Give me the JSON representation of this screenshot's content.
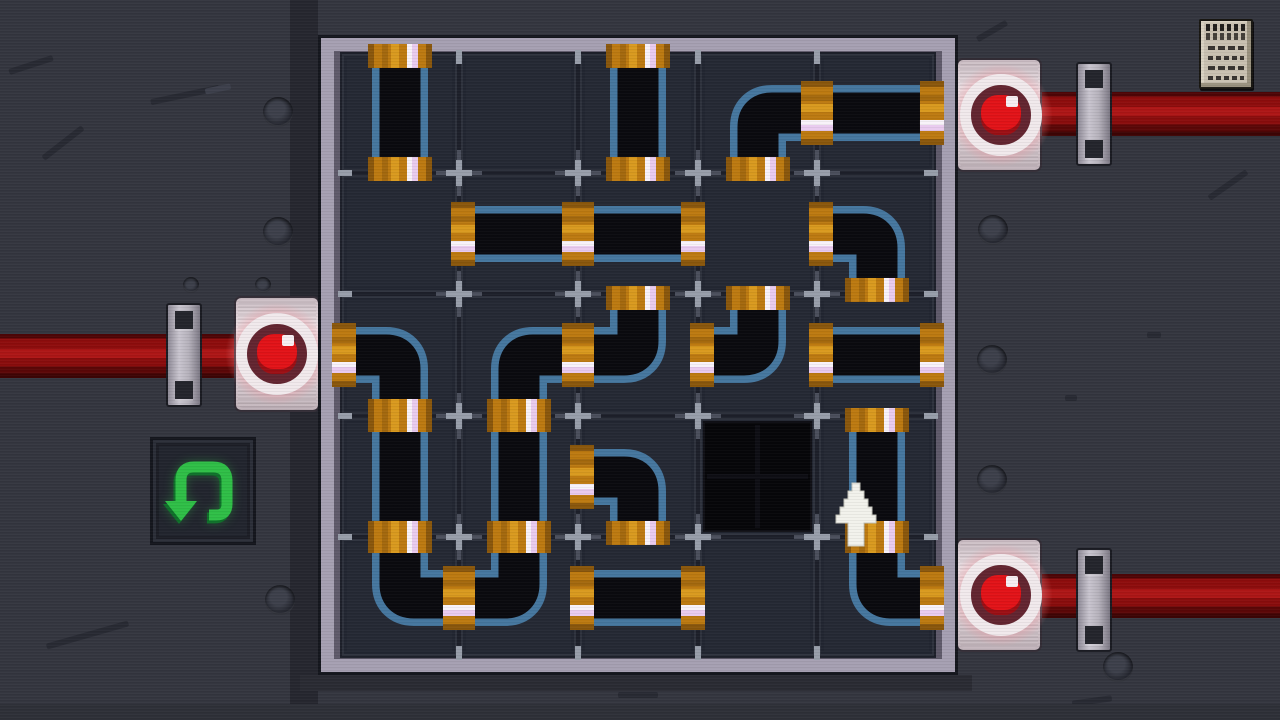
{
  "puzzle": {
    "rows": 5,
    "cols": 5,
    "cells": [
      [
        "v",
        "",
        "v",
        "SE",
        "h"
      ],
      [
        "",
        "h",
        "h",
        "",
        "SW"
      ],
      [
        "SW",
        "SE",
        "NW",
        "NW",
        "h"
      ],
      [
        "v",
        "v",
        "SW",
        "hole",
        "v"
      ],
      [
        "NE",
        "NW",
        "h",
        "",
        "NE"
      ]
    ],
    "legend": {
      "v": "vertical-pipe",
      "h": "horizontal-pipe",
      "SE": "elbow-bottom-right",
      "SW": "elbow-bottom-left",
      "NW": "elbow-top-left",
      "NE": "elbow-top-right",
      "hole": "empty-socket",
      "": "empty-cell"
    }
  },
  "valves": [
    {
      "name": "left-valve",
      "side": "left",
      "grid_row": 2,
      "light": "red"
    },
    {
      "name": "top-right-valve",
      "side": "right",
      "grid_row": 0,
      "light": "red"
    },
    {
      "name": "bottom-right-valve",
      "side": "right",
      "grid_row": 4,
      "light": "red"
    }
  ],
  "hud": {
    "undo_button_icon": "undo-arrow-icon",
    "notes_icon": "notepad-icon"
  },
  "cursor": {
    "icon": "up-arrow-cursor",
    "over_cell": {
      "row": 3,
      "col": 4
    }
  },
  "colors": {
    "background": "#34363f",
    "frame_light": "#a6a0b2",
    "cell": "#252934",
    "pipe_edge": "#46779f",
    "pipe_body": "#0a0a0f",
    "coupling_orange": "#bd7a11",
    "coupling_dark": "#8a570c",
    "coupling_mid": "#a4690e",
    "coupling_light": "#d99a1f",
    "coupling_pink": "#e9cbef",
    "coupling_white": "#f8f2f9",
    "red_pipe": "#9c1111",
    "valve_red": "#e21318",
    "valve_plate": "#e3d7db",
    "undo_green": "#2fbf47"
  }
}
